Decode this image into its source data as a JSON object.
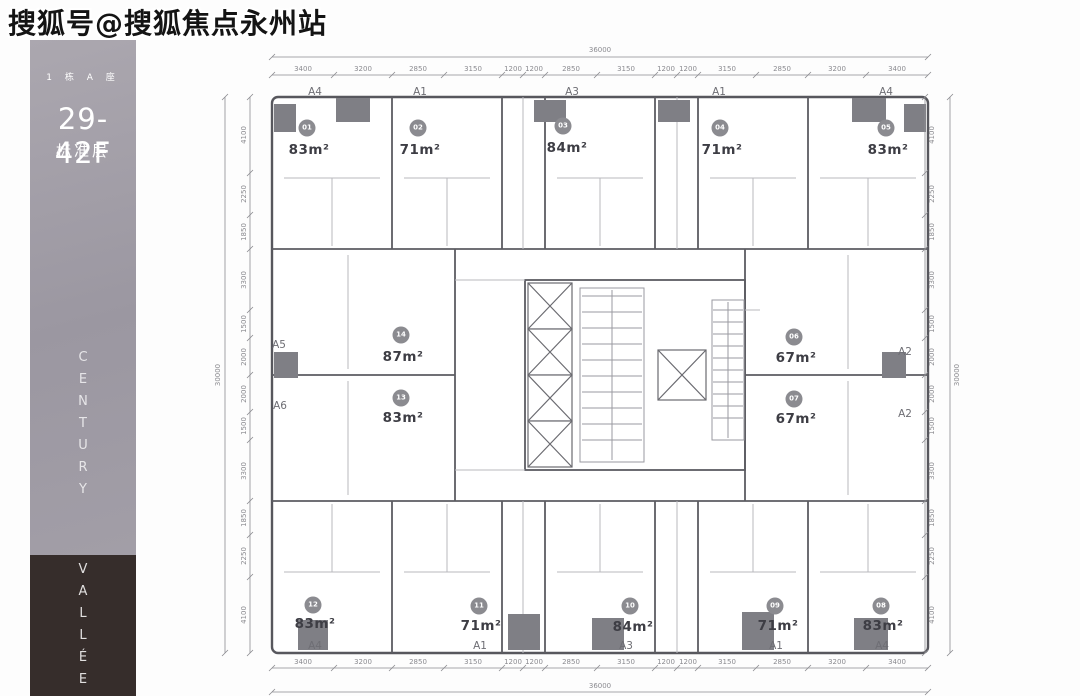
{
  "watermark": {
    "text": "搜狐号@搜狐焦点永州站"
  },
  "sidebar": {
    "building": "1 栋 A 座",
    "floor_range": "29-42F",
    "floor_type": "标准层",
    "brand_line1": "CENTURY",
    "brand_line2": "VALLÉE",
    "top_bg": "#a39fa8",
    "bottom_bg": "#362d2b"
  },
  "plan": {
    "overall": {
      "width": "36000",
      "height": "30000"
    },
    "axis": {
      "top": [
        "A4",
        "A1",
        "A3",
        "A1",
        "A4"
      ],
      "bottom": [
        "A4",
        "A1",
        "A3",
        "A1",
        "A4"
      ],
      "left": [
        "A5",
        "A6"
      ],
      "right": [
        "A2",
        "A2"
      ]
    },
    "dims": {
      "top": [
        "3400",
        "3200",
        "2850",
        "3150",
        "1200",
        "1200",
        "2850",
        "3150",
        "1200",
        "1200",
        "3150",
        "2850",
        "3200",
        "3400"
      ],
      "bottom": [
        "3400",
        "3200",
        "2850",
        "3150",
        "1200",
        "1200",
        "2850",
        "3150",
        "1200",
        "1200",
        "3150",
        "2850",
        "3200",
        "3400"
      ],
      "left": [
        "4100",
        "2250",
        "1850",
        "3300",
        "1500",
        "2000",
        "2000",
        "1500",
        "3300",
        "1850",
        "2250",
        "4100"
      ],
      "right": [
        "4100",
        "2250",
        "1850",
        "3300",
        "1500",
        "2000",
        "2000",
        "1500",
        "3300",
        "1850",
        "2250",
        "4100"
      ]
    },
    "units": [
      {
        "id": "01",
        "area": "83m²"
      },
      {
        "id": "02",
        "area": "71m²"
      },
      {
        "id": "03",
        "area": "84m²"
      },
      {
        "id": "04",
        "area": "71m²"
      },
      {
        "id": "05",
        "area": "83m²"
      },
      {
        "id": "06",
        "area": "67m²"
      },
      {
        "id": "07",
        "area": "67m²"
      },
      {
        "id": "08",
        "area": "83m²"
      },
      {
        "id": "09",
        "area": "71m²"
      },
      {
        "id": "10",
        "area": "84m²"
      },
      {
        "id": "11",
        "area": "71m²"
      },
      {
        "id": "12",
        "area": "83m²"
      },
      {
        "id": "13",
        "area": "83m²"
      },
      {
        "id": "14",
        "area": "87m²"
      }
    ],
    "colors": {
      "wall": "#57575d",
      "badge": "#8b8b90",
      "area_text": "#3d3d44",
      "dim_text": "#8b8b90"
    }
  }
}
